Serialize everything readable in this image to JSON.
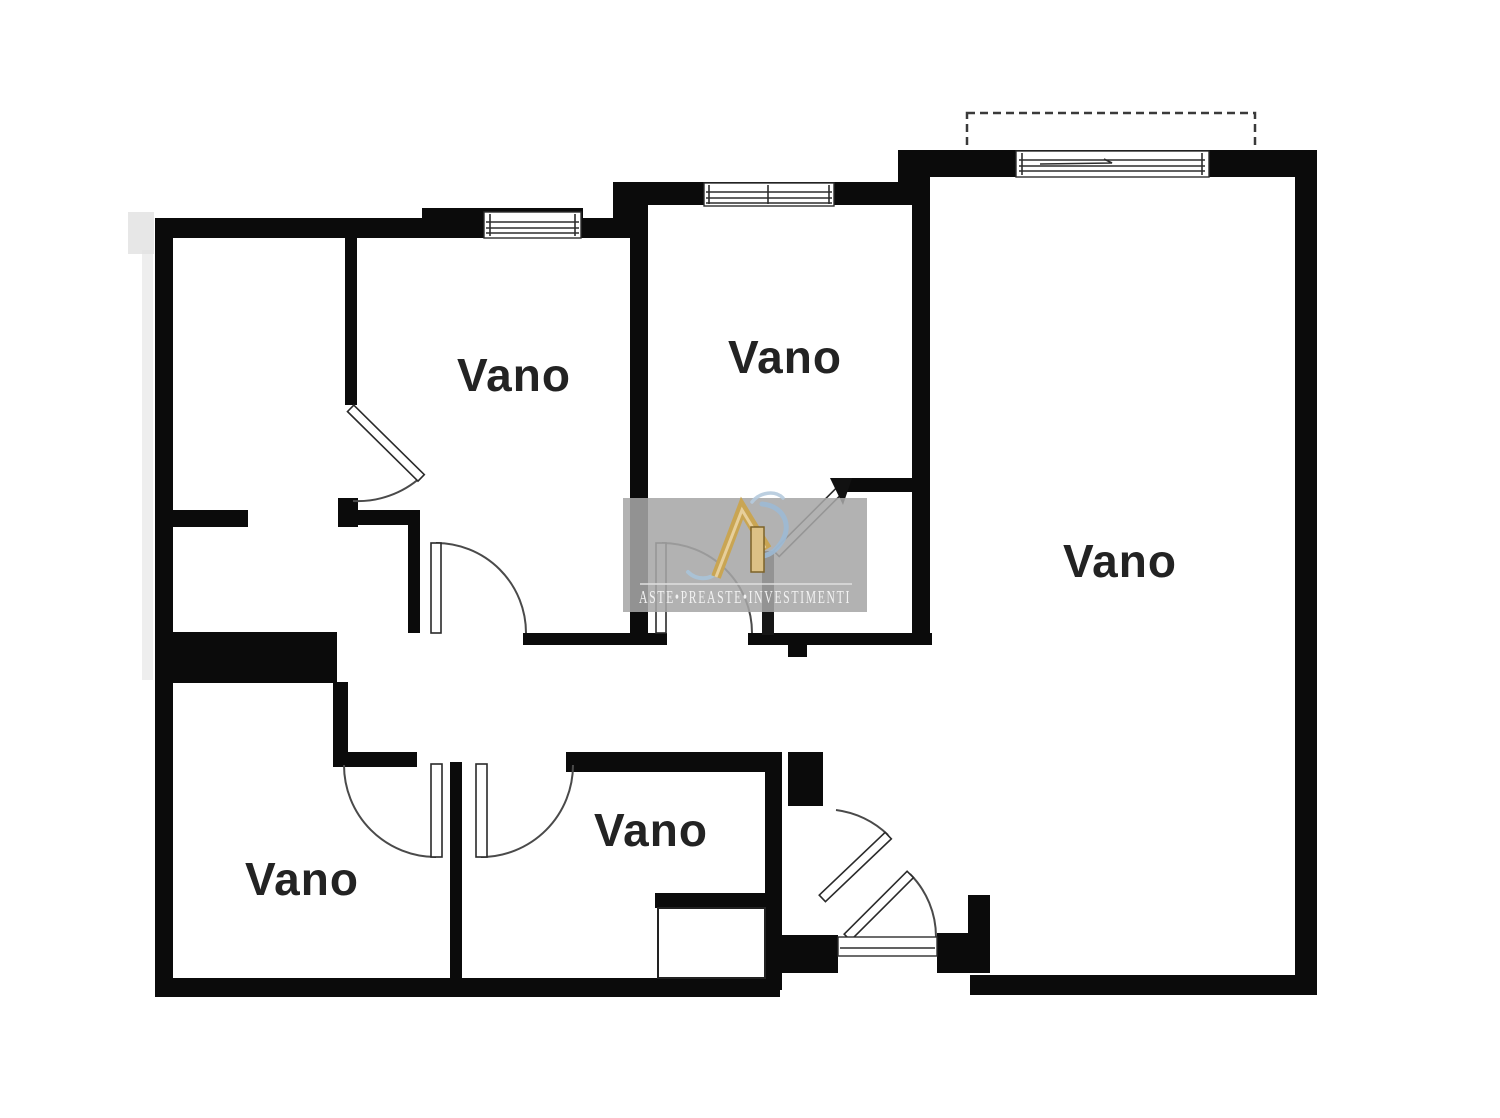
{
  "page": {
    "background": "#ffffff"
  },
  "plan": {
    "type": "floor-plan",
    "wall_color": "#0b0b0b",
    "door_arc_color": "#4a4a4a",
    "label_color": "#232323",
    "room_labels": [
      {
        "id": "room-top-left",
        "text": "Vano"
      },
      {
        "id": "room-top-middle",
        "text": "Vano"
      },
      {
        "id": "room-right",
        "text": "Vano"
      },
      {
        "id": "room-bottom-left",
        "text": "Vano"
      },
      {
        "id": "room-bottom-middle",
        "text": "Vano"
      }
    ]
  },
  "watermark": {
    "text": "ASTE•PREASTE•INVESTIMENTI",
    "background": "#a6a6a6",
    "gold": "#c9a553",
    "gold_light": "#e7cf9b",
    "blue": "#9cb9d4",
    "text_color": "#f2f2f2"
  }
}
